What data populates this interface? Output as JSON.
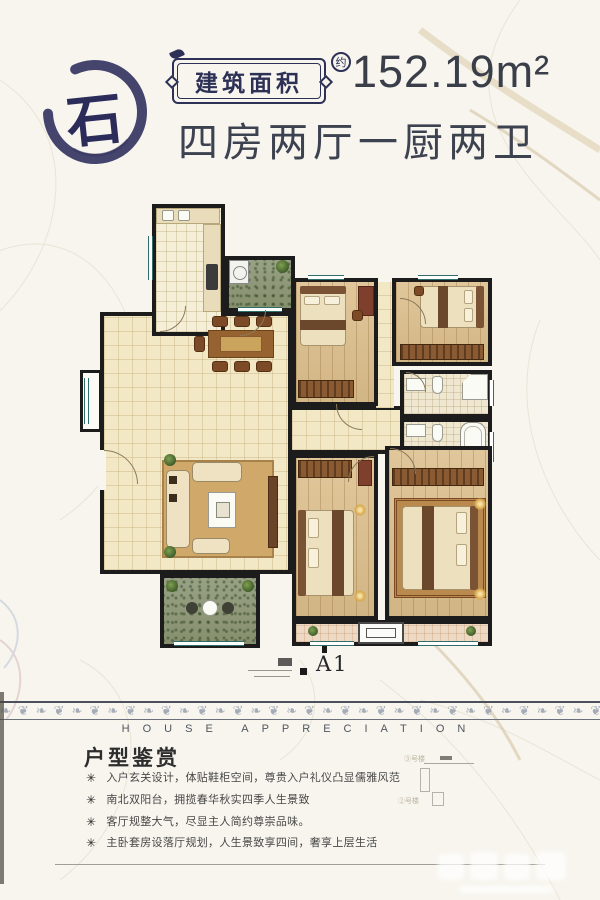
{
  "header": {
    "logo_char": "石",
    "badge_label": "建筑面积",
    "approx_label": "约",
    "area_text": "152.19m²",
    "layout_text": "四房两厅一厨两卫"
  },
  "plan": {
    "unit_label": "A1"
  },
  "divider": {
    "title": "HOUSE APPRECIATION"
  },
  "section": {
    "heading": "户型鉴赏",
    "bullet_marker": "✳",
    "bullets": [
      "入户玄关设计，体贴鞋柜空间，尊贵入户礼仪凸显儒雅风范",
      "南北双阳台，拥揽春华秋实四季人生景致",
      "客厅规整大气，尽显主人简约尊崇品味。",
      "主卧套房设落厅规划，人生景致享四间，奢享上层生活"
    ]
  },
  "siteplan": {
    "labels": [
      "③号楼",
      "②号楼"
    ]
  },
  "colors": {
    "ink_navy": "#2d3156",
    "text_dark": "#3d4250",
    "wall": "#1c1c1c",
    "tile_cream": "#f3e8c6",
    "wood": "#d9bd8f",
    "balcony_green": "#8e9879",
    "accent_brown": "#8a5a33",
    "lamp_glow": "#e7c36f",
    "window_teal": "#2f6e68"
  }
}
